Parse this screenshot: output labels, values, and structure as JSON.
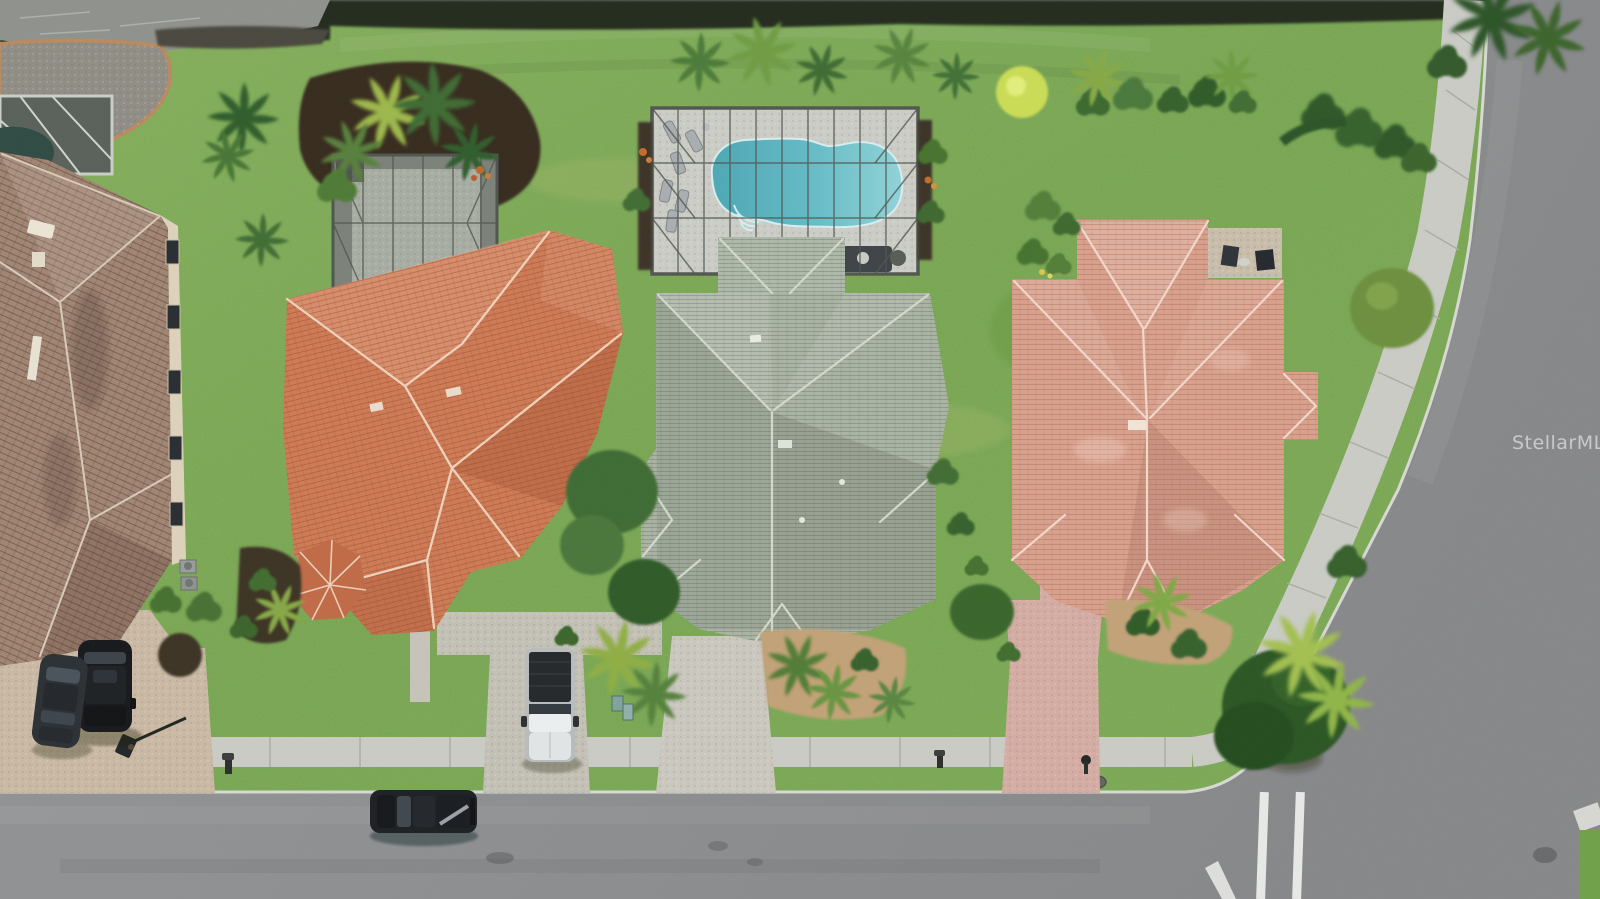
{
  "image": {
    "kind": "aerial-drone-photo",
    "subject": "Overhead view of a Florida residential street with three single-family homes, a screened swimming pool, driveways with parked vehicles, sidewalks and a curved corner street",
    "width_px": 1600,
    "height_px": 899
  },
  "watermark": {
    "text": "StellarMLS"
  },
  "palette": {
    "grass": "#6fa047",
    "grass_light": "#8fb35a",
    "grass_dark": "#54842f",
    "asphalt": "#8d9092",
    "concrete_sidewalk": "#c9cbc4",
    "pool_water": "#62bac4",
    "pool_deck": "#cbccc6",
    "screen_enclosure_frame": "#565b55",
    "roof_left_terracotta": "#cd7a55",
    "roof_center_sage_green": "#a9b3a3",
    "roof_right_salmon": "#d9a08c",
    "roof_neighbor_brown": "#a08472",
    "driveway_tan_pavers": "#c9b9a4",
    "driveway_pink_pavers": "#d4aca3",
    "mulch_dark": "#362c20",
    "mulch_tan": "#c2a176",
    "pond_water": "#8e918c",
    "road_marking_white": "#e8e9e6"
  },
  "scene": {
    "houses": [
      {
        "name": "neighbor-house-partial",
        "position": "far left edge",
        "roof": "brown two-story tile roof with screened lanai and small dark pool"
      },
      {
        "name": "left-house",
        "position": "center-left",
        "roof": "orange terracotta tile hip roof with screened rear patio"
      },
      {
        "name": "middle-house",
        "position": "center",
        "roof": "sage green shingle hip roof with screened pool enclosure"
      },
      {
        "name": "right-house",
        "position": "center-right",
        "roof": "light salmon tile hip roof with rear paver patio and two chairs"
      }
    ],
    "pool": {
      "shape": "freeform",
      "water_color": "#62bac4",
      "enclosure": "screened lanai with grey frame grid",
      "loungers": 6
    },
    "vehicles": [
      {
        "name": "black-suv",
        "location": "left driveway"
      },
      {
        "name": "dark-sedan",
        "location": "left driveway"
      },
      {
        "name": "white-pickup-truck",
        "location": "center driveway, dark bed cover"
      },
      {
        "name": "dark-pickup-truck",
        "location": "driving on bottom street"
      }
    ],
    "roads": [
      {
        "name": "bottom-street",
        "orientation": "horizontal"
      },
      {
        "name": "right-curved-street",
        "orientation": "curving from top right to intersection"
      }
    ],
    "landmarks": [
      "pond-shoreline-top-left",
      "rock-bed",
      "sidewalks-with-joints",
      "basketball-hoop",
      "mailboxes",
      "palm-trees-and-shrubs",
      "intersection-stop-lines",
      "storm-drain"
    ]
  }
}
